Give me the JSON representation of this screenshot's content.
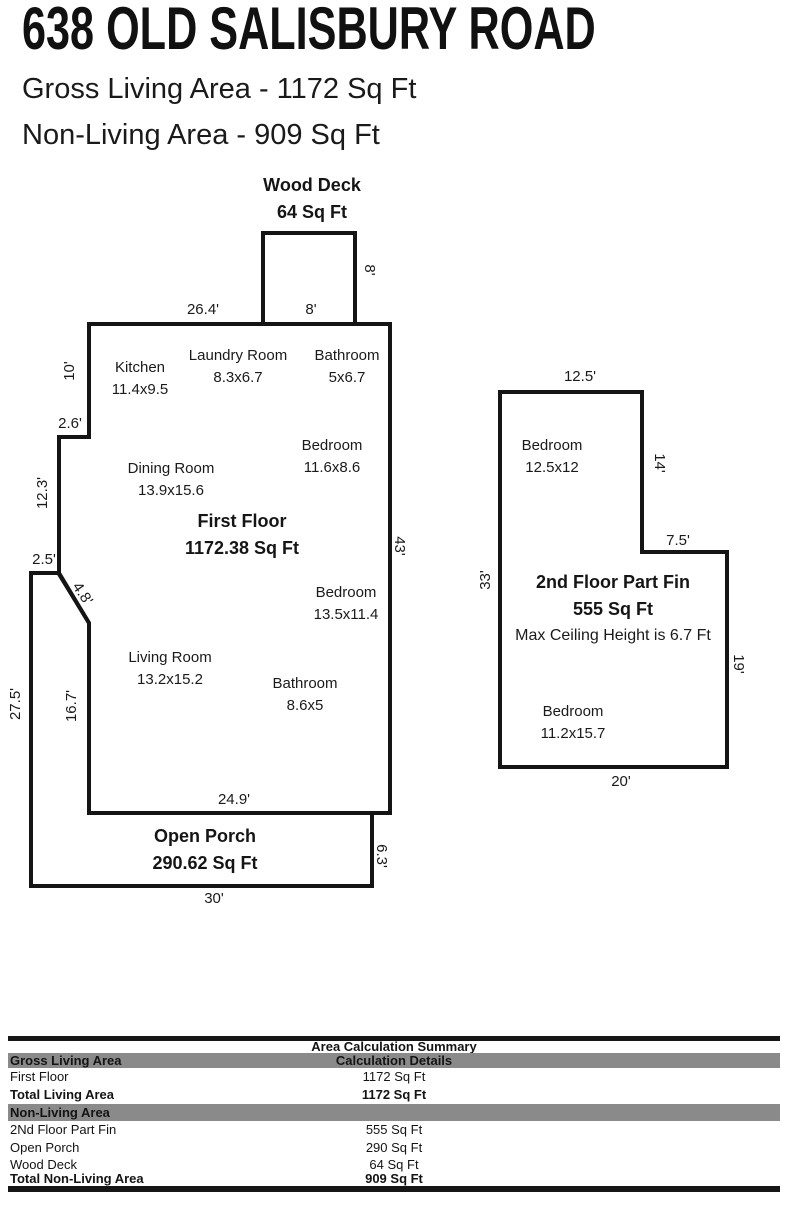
{
  "header": {
    "title": "638 OLD SALISBURY ROAD",
    "subtitle1": "Gross Living Area - 1172 Sq Ft",
    "subtitle2": "Non-Living Area - 909 Sq Ft"
  },
  "colors": {
    "wall": "#151515",
    "text": "#1a1a1a",
    "table_gray": "#8a8a8a",
    "table_bar": "#161616"
  },
  "floor1": {
    "deck": {
      "title": "Wood Deck",
      "area": "64 Sq Ft"
    },
    "title": "First Floor",
    "area": "1172.38 Sq Ft",
    "porch": {
      "title": "Open Porch",
      "area": "290.62 Sq Ft"
    },
    "rooms": [
      {
        "name": "Kitchen",
        "dims": "11.4x9.5"
      },
      {
        "name": "Laundry Room",
        "dims": "8.3x6.7"
      },
      {
        "name": "Bathroom",
        "dims": "5x6.7"
      },
      {
        "name": "Bedroom",
        "dims": "11.6x8.6"
      },
      {
        "name": "Dining Room",
        "dims": "13.9x15.6"
      },
      {
        "name": "Bedroom",
        "dims": "13.5x11.4"
      },
      {
        "name": "Living Room",
        "dims": "13.2x15.2"
      },
      {
        "name": "Bathroom",
        "dims": "8.6x5"
      }
    ],
    "dims": {
      "top": "26.4'",
      "deck_bottom": "8'",
      "deck_right": "8'",
      "left_upper": "10'",
      "notch_upper": "2.6'",
      "left_mid": "12.3'",
      "notch_lower": "2.5'",
      "diagonal": "4.8'",
      "porch_left": "27.5'",
      "left_lower": "16.7'",
      "right": "43'",
      "bottom_inner": "24.9'",
      "porch_right": "6.3'",
      "porch_bottom": "30'"
    }
  },
  "floor2": {
    "title": "2nd Floor Part Fin",
    "area": "555 Sq Ft",
    "note": "Max Ceiling Height is 6.7 Ft",
    "rooms": [
      {
        "name": "Bedroom",
        "dims": "12.5x12"
      },
      {
        "name": "Bedroom",
        "dims": "11.2x15.7"
      }
    ],
    "dims": {
      "top": "12.5'",
      "right_upper": "14'",
      "step": "7.5'",
      "left": "33'",
      "right_lower": "19'",
      "bottom": "20'"
    }
  },
  "table": {
    "title": "Area Calculation Summary",
    "living_header": "Gross Living Area",
    "details_header": "Calculation Details",
    "living_rows": [
      {
        "label": "First Floor",
        "value": "1172 Sq Ft"
      }
    ],
    "living_total": {
      "label": "Total Living Area",
      "value": "1172 Sq Ft"
    },
    "nonliving_header": "Non-Living Area",
    "nonliving_rows": [
      {
        "label": "2Nd Floor Part Fin",
        "value": "555 Sq Ft"
      },
      {
        "label": "Open Porch",
        "value": "290 Sq Ft"
      },
      {
        "label": "Wood Deck",
        "value": "64 Sq Ft"
      }
    ],
    "nonliving_total": {
      "label": "Total Non-Living Area",
      "value": "909 Sq Ft"
    }
  }
}
